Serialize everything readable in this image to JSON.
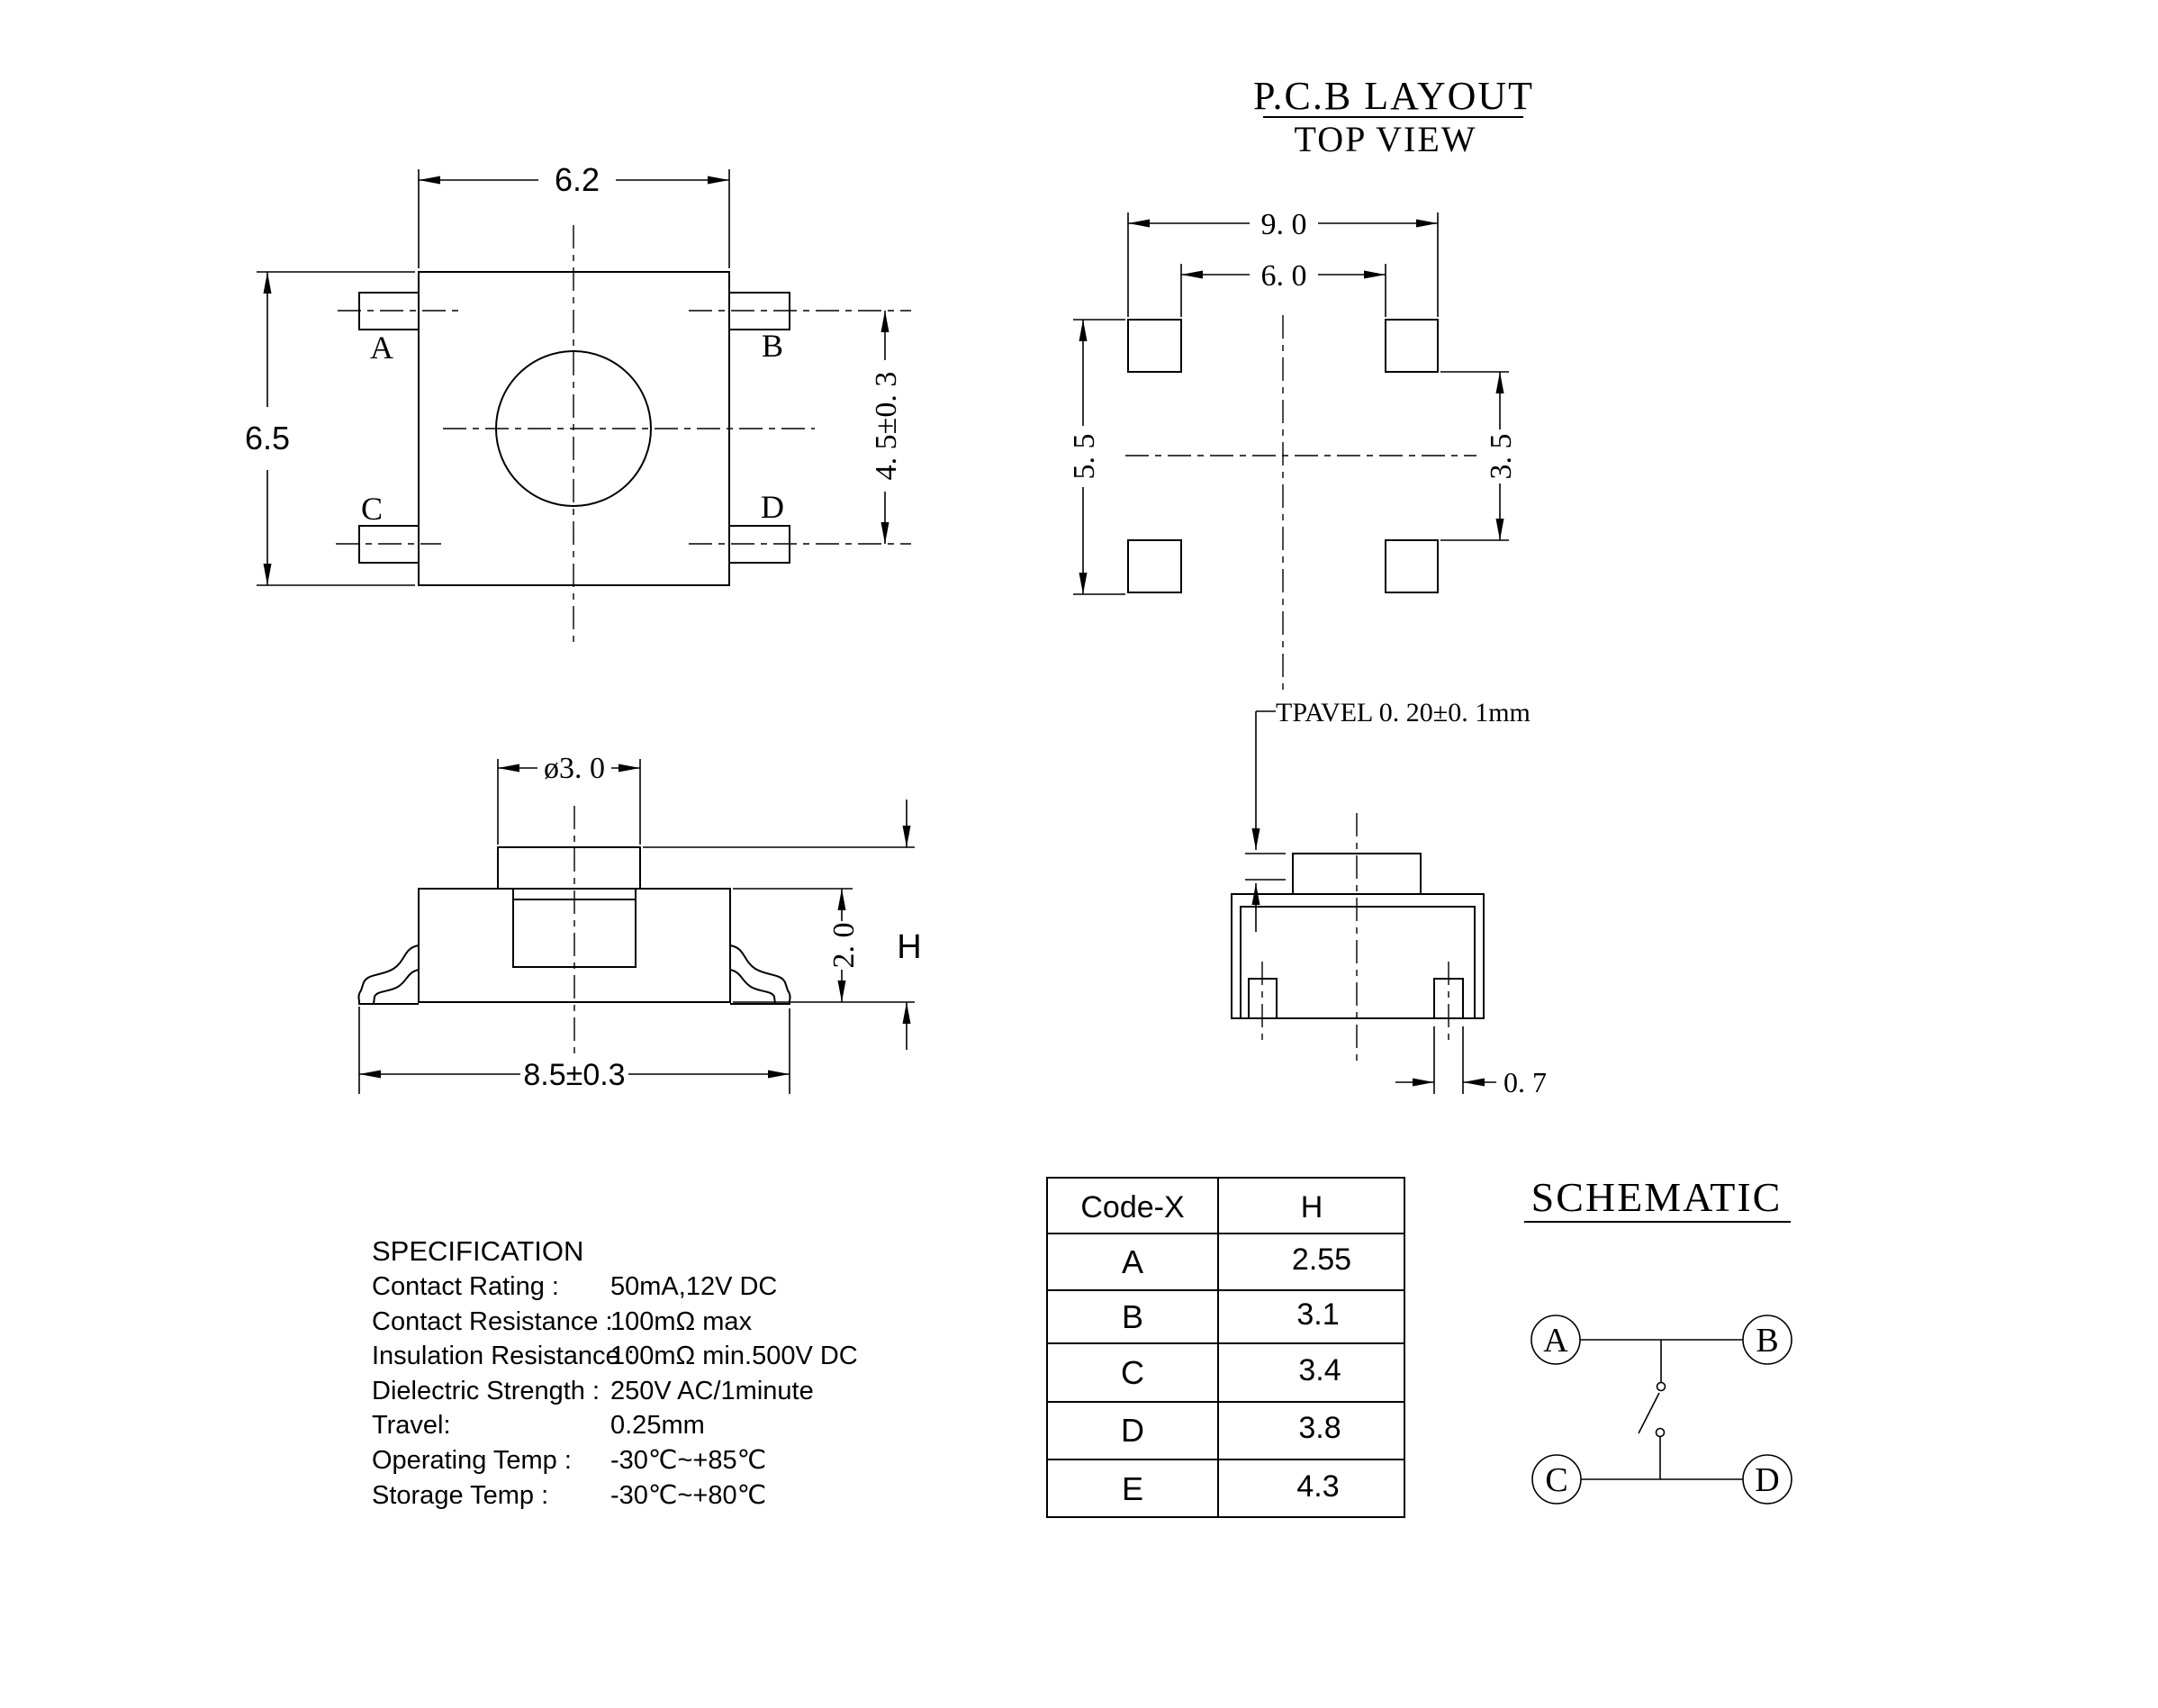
{
  "top_view": {
    "dim_width": "6.2",
    "dim_height": "6.5",
    "dim_terminal_pitch": "4. 5±0. 3",
    "pin_a": "A",
    "pin_b": "B",
    "pin_c": "C",
    "pin_d": "D"
  },
  "pcb_layout": {
    "title": "P.C.B LAYOUT",
    "subtitle": "TOP VIEW",
    "dim_outer": "9. 0",
    "dim_inner": "6. 0",
    "dim_left": "5. 5",
    "dim_right": "3. 5"
  },
  "side_view": {
    "dim_knob": "ø3. 0",
    "dim_body": "2. 0",
    "dim_height_label": "H",
    "dim_width": "8.5±0.3"
  },
  "travel_view": {
    "note": "TPAVEL 0. 20±0. 1mm",
    "dim_foot": "0. 7"
  },
  "spec": {
    "title": "SPECIFICATION",
    "rows": [
      {
        "label": "Contact  Rating :",
        "value": "50mA,12V DC"
      },
      {
        "label": "Contact  Resistance :",
        "value": "100mΩ max"
      },
      {
        "label": "Insulation Resistance :",
        "value": "100mΩ min.500V DC"
      },
      {
        "label": "Dielectric  Strength :",
        "value": "250V AC/1minute"
      },
      {
        "label": "Travel:",
        "value": "0.25mm"
      },
      {
        "label": "Operating Temp :",
        "value": "-30℃~+85℃"
      },
      {
        "label": "Storage Temp :",
        "value": "-30℃~+80℃"
      }
    ]
  },
  "code_table": {
    "col1": "Code-X",
    "col2": "H",
    "rows": [
      {
        "code": "A",
        "h": "2.55"
      },
      {
        "code": "B",
        "h": "3.1"
      },
      {
        "code": "C",
        "h": "3.4"
      },
      {
        "code": "D",
        "h": "3.8"
      },
      {
        "code": "E",
        "h": "4.3"
      }
    ]
  },
  "schematic": {
    "title": "SCHEMATIC",
    "pin_a": "A",
    "pin_b": "B",
    "pin_c": "C",
    "pin_d": "D"
  }
}
